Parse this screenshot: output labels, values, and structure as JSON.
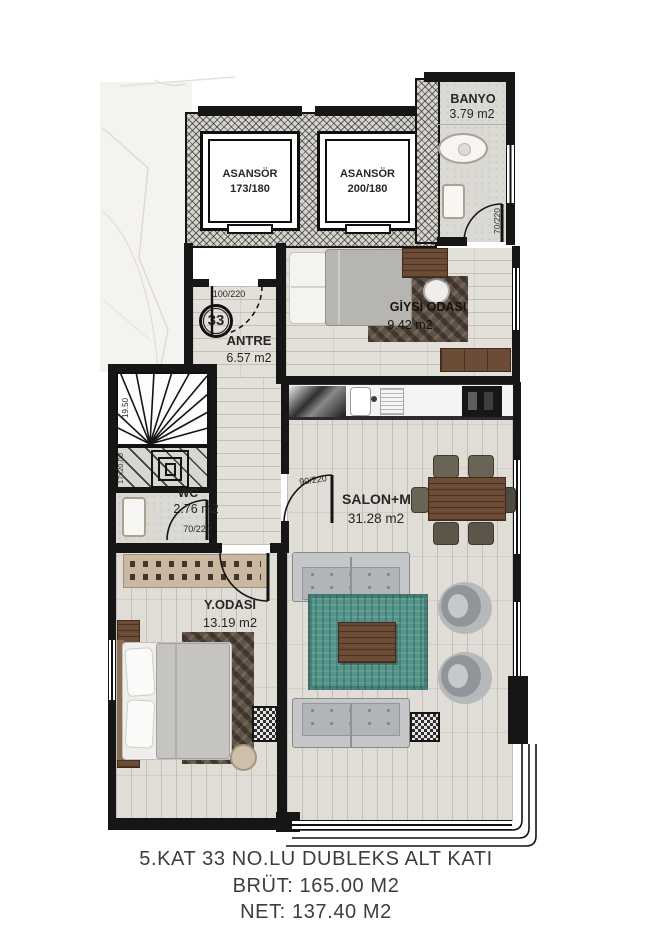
{
  "floorplan": {
    "badge": "33",
    "rooms": {
      "banyo": {
        "name": "BANYO",
        "area": "3.79 m2"
      },
      "asansor_left": {
        "name": "ASANSÖR",
        "size": "173/180"
      },
      "asansor_right": {
        "name": "ASANSÖR",
        "size": "200/180"
      },
      "antre": {
        "name": "ANTRE",
        "area": "6.57 m2"
      },
      "giysi_odasi": {
        "name": "GİYSİ ODASI",
        "area": "9.42 m2"
      },
      "salon": {
        "name": "SALON+M.NİŞİ",
        "area": "31.28 m2"
      },
      "wc": {
        "name": "WC",
        "area": "2.76 m2"
      },
      "y_odasi": {
        "name": "Y.ODASI",
        "area": "13.19 m2"
      }
    },
    "doors": {
      "antre": "100/220",
      "salon": "90/220",
      "wc": "70/220",
      "banyo": "70/220"
    },
    "stairs": {
      "upper": "19.50",
      "lower": "17x20.00"
    },
    "caption": {
      "line1": "5.KAT 33 NO.LU DUBLEKS ALT KATI",
      "line2": "BRÜT: 165.00 M2",
      "line3": "NET: 137.40 M2"
    },
    "colors": {
      "wall": "#161616",
      "rug": "#55948b",
      "wood": "#6d4c37",
      "sofa": "#c4c6c7"
    }
  }
}
